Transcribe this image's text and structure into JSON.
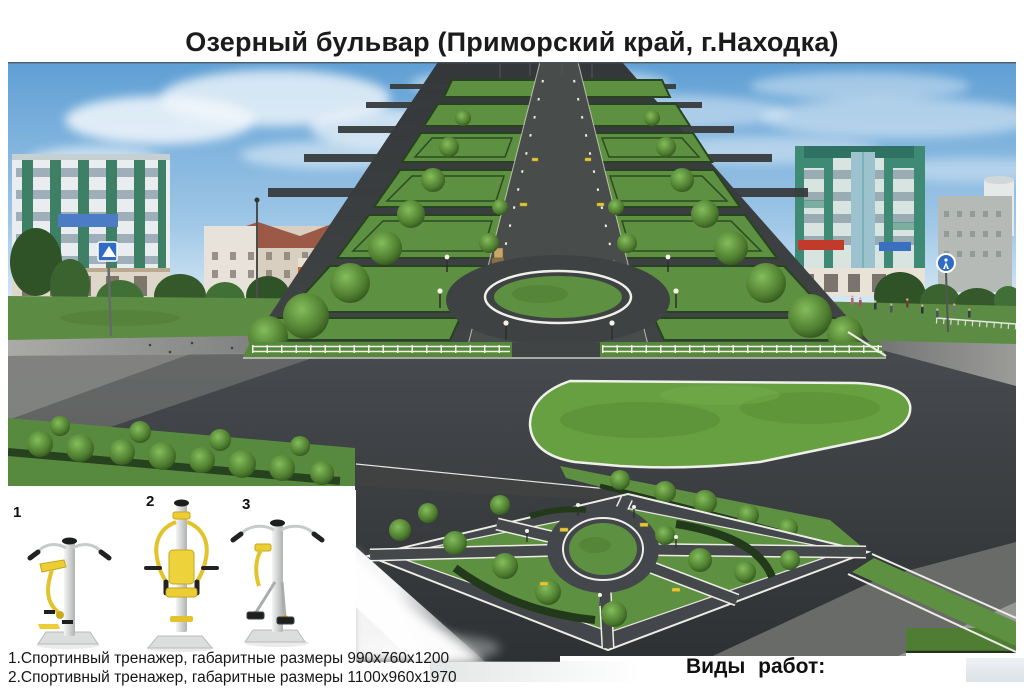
{
  "title": "Озерный бульвар (Приморский край, г.Находка)",
  "equipment_panel": {
    "items": [
      {
        "number": "1"
      },
      {
        "number": "2"
      },
      {
        "number": "3"
      }
    ],
    "captions": [
      "1.Спортинвый тренажер, габаритные размеры 990х760х1200",
      "2.Спортивный тренажер, габаритные размеры 1100х960х1970"
    ]
  },
  "works_section": {
    "label": "Виды работ:"
  },
  "colors": {
    "sky": "#5f9fd4",
    "render_grass": "#5d9040",
    "render_asphalt": "#3b3e3d",
    "path_outline": "#f0f0ea",
    "hedge": "#27431f",
    "equipment_yellow": "#eccd35",
    "teal_building": "#3f8a74",
    "title_text": "#1b1b1b"
  }
}
